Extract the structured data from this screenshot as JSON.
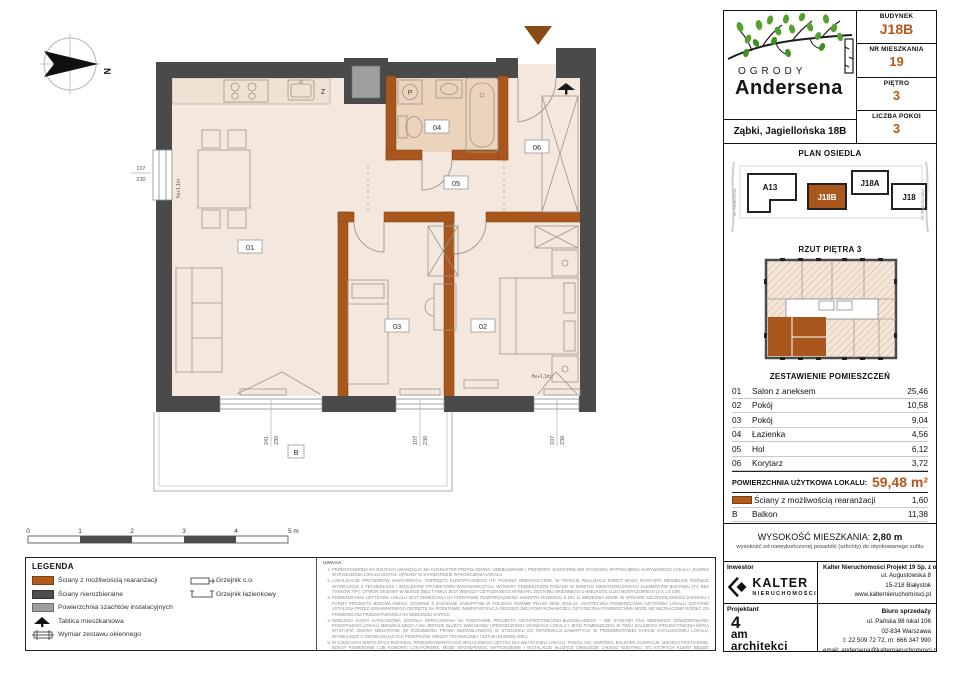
{
  "header": {
    "brand_line1": "OGRODY",
    "brand_line2": "Andersena",
    "address": "Ząbki, Jagiellońska 18B",
    "fields": [
      {
        "label": "BUDYNEK",
        "value": "J18B"
      },
      {
        "label": "NR MIESZKANIA",
        "value": "19"
      },
      {
        "label": "PIĘTRO",
        "value": "3"
      },
      {
        "label": "LICZBA POKOI",
        "value": "3"
      }
    ]
  },
  "site_plan": {
    "title": "PLAN OSIEDLA",
    "buildings": {
      "a13": "A13",
      "j18b": "J18B",
      "j18a": "J18A",
      "j18": "J18"
    },
    "street_left": "ul. Andersena",
    "street_right": "ul. Jagiellońska"
  },
  "floor_overview": {
    "title": "RZUT PIĘTRA 3"
  },
  "rooms_table": {
    "title": "ZESTAWIENIE POMIESZCZEŃ",
    "rows": [
      {
        "no": "01",
        "name": "Salon z aneksem",
        "area": "25,46"
      },
      {
        "no": "02",
        "name": "Pokój",
        "area": "10,58"
      },
      {
        "no": "03",
        "name": "Pokój",
        "area": "9,04"
      },
      {
        "no": "04",
        "name": "Łazienka",
        "area": "4,56"
      },
      {
        "no": "05",
        "name": "Hol",
        "area": "6,12"
      },
      {
        "no": "06",
        "name": "Korytarz",
        "area": "3,72"
      }
    ],
    "total_label": "POWIERZCHNIA UŻYTKOWA LOKALU:",
    "total_value": "59,48 m²",
    "rearr_row": {
      "name": "Ściany z możliwością rearanżacji",
      "area": "1,60"
    },
    "balcony_row": {
      "no": "B",
      "name": "Balkon",
      "area": "11,38"
    }
  },
  "height_info": {
    "label": "WYSOKOŚĆ MIESZKANIA:",
    "value": "2,80 m",
    "note": "wysokość od niewykończonej posadzki (szlichty) do otynkowanego sufitu"
  },
  "footer": {
    "investor_label": "Inwestor",
    "investor_logo_line1": "KALTER",
    "investor_logo_line2": "NIERUCHOMOŚCI",
    "company_name": "Kalter Nieruchomości Projekt 19 Sp. z o.o.",
    "company_lines": [
      "ul. Augustowska 8",
      "15-218 Białystok",
      "www.kalternieruchomosci.pl"
    ],
    "designer_label": "Projektant",
    "designer_line1": "4",
    "designer_line2": "am",
    "designer_line3": "architekci",
    "sales_title": "Biuro sprzedaży",
    "sales_lines": [
      "ul. Pańska 98 lokal 106",
      "02-834 Warszawa",
      "t: 22 509 72 72, m: 666 347 990",
      "email: andersena@kalternieruchomosci.pl"
    ]
  },
  "legend": {
    "title": "LEGENDA",
    "col1": [
      {
        "label": "Ściany z możliwością rearanżacji"
      },
      {
        "label": "Ściany nierozbieralne"
      },
      {
        "label": "Powierzchnia szachtów instalacyjnych"
      },
      {
        "label": "Tablica mieszkaniowa"
      },
      {
        "label": "Wymiar zestawu okiennego"
      }
    ],
    "col2": [
      {
        "label": "Grzejnik c.o."
      },
      {
        "label": "Grzejnik łazienkowy"
      }
    ]
  },
  "notes": {
    "title": "UWAGA:",
    "items": [
      "PRZEDSTAWIONA NA RZUTACH ARANŻACJA MA CHARAKTER PRZYKŁADOWY. UMEBLOWANIE I PRZYBORY SANITARNE NIE STANOWIĄ WYPOSAŻENIA NABYWANEGO LOKALU. ZAKRES WYPOSAŻENIA LOKALU ZOSTAŁ OPISANY W STANDARDZIE WYKOŃCZENIA LOKALU.",
      "LOKALIZACJE PRZYBORÓW SANITARNYCH, OSPRZĘTU ELEKTRYCZNEGO ITP. PODANO ORIENTACYJNIE. W TRAKCIE REALIZACJI ROBÓT MOGĄ WYSTĄPIĆ NIEWIELKIE RÓŻNICE WYNIKAJĄCE Z TECHNOLOGII I WZGLĘDÓW PROJEKTOWO-WYKONAWCZYCH. WYMIARY POMIESZCZEŃ PODANO W ŚWIETLE NIEWYKOŃCZONYCH ELEMENTÓW BUDYNKU (TJ. BEZ TYNKÓW ITP.). OTWÓR OKIENNY W MURZE (BEZ TYNKU) JEST WIĘKSZY OD PODANEGO WYMIARU ZESTAWU OKIENNEGO O WIELKOŚĆ LUZU MONTAŻOWEGO (2 X 1,5 CM).",
      "POWIERZCHNIA UŻYTKOWA LOKALU JEST OKREŚLONA NA PODSTAWIE ROZPORZĄDZENIA MINISTRA ROZWOJU Z DN. 11 WRZEŚNIA 2020R. W SPRAWIE SZCZEGÓŁOWEGO ZAKRESU I FORMY PROJEKTU BUDOWLANEGO, ZGODNIE Z ZASADAMI ZAWARTYMI W POLSKIEJ NORMIE PN-ISO 9836: 2015-12. OSTATECZNA POWIERZCHNIA UŻYTKOWA LOKALU ZOSTANIE USTALONA PRZEZ UPRAWNIONEGO GEODETĘ NA PODSTAWIE INWENTARYZACJI GEODEZYJNEJ POWYKONAWCZEJ. OSTATECZNA POWIERZCHNIA MOŻE SIĘ NIEZNACZNIE RÓŻNIĆ OD POWIERZCHNI PRZEDSTAWIONEJ NA NINIEJSZEJ KARCIE.",
      "NINIEJSZA KARTA KATALOGOWA ZOSTAŁA OPRACOWANA NA PODSTAWIE PROJEKTU ARCHITEKTONICZNO-BUDOWLANEGO – NIE STANOWI ONA WIERNEGO ODWZOROWANIA POWSTAŁEGO LOKALU MIESZKALNEGO A MA JEDYNIE SŁUŻYĆ WSKAZANIU UPROSZCZONEJ ARANŻACJI LOKALU I JEGO POMIESZCZEŃ. W TOKU DALSZEGO PROJEKTOWANIA MOGĄ WYSTĄPIĆ ZMIANY NIEISTOTNE (W ROZUMIENIU PRAWA BUDOWLANEGO) W STOSUNKU DO INFORMACJI ZAWARTYCH W PRZEDMIOTOWEJ KARCIE KATALOGOWEJ LOKALU, WYNIKAJĄCE Z OBOWIĄZUJĄCYCH PRZEPISÓW, WIEDZY TECHNICZNEJ I SZTUKI BUDOWLANEJ.",
      "W CZĘŚCIACH WSPÓLNYCH BUDYNKU, PRZEWIDYWANYCH DO WYŁĄCZNEGO UŻYTKU DLA WŁAŚCICIELI LOKALU, TAKICH JAK: OGRÓDKI, BALKONY, ELEWACJE, MIEJSCA POSTOJOWE, BOKSY ROWEROWE LUB KOMÓRKI LOKATORSKIE, MOŻE WYSTĘPOWAĆ WYPOSAŻENIE I INSTALACJE SŁUŻĄCE OBSŁUDZE CAŁEGO BUDYNKU, DO KTÓRYCH KLIENT BĘDZIE ZOBOWIĄZANY UMOŻLIWIĆ DOSTĘP.",
      "NINIEJSZA KARTA NIE PRZEDSTAWIA KOMPLETNEGO PROJEKTU WIELOBRANŻOWEGO. RYSUNEK NIE JEST PRZEZNACZONY DO CELÓW WYKONAWCZYCH. SZCZEGÓŁOWE INFORMACJE PROJEKTOWE ZNAJDUJĄ SIĘ W DOKUMENTACJI TECHNICZNO-WYKONAWCZEJ DOSTĘPNEJ DO WGLĄDU DLA KLIENTÓW W BIURZE INWESTORA.",
      "PROJEKT CHRONIONY PRAWEM AUTORSKIM."
    ]
  },
  "plan": {
    "compass_label": "N",
    "room_labels": {
      "salon": "01",
      "pokoj_02": "02",
      "pokoj_03": "03",
      "lazienka": "04",
      "hol": "05",
      "korytarz": "06",
      "balkon": "B",
      "kitchen_z": "Z",
      "washer": "P"
    },
    "window_dims": {
      "left": {
        "w": "107",
        "h": "230"
      },
      "salon": {
        "w": "241",
        "h": "230"
      },
      "pokoj_03": {
        "w": "107",
        "h": "230"
      },
      "pokoj_02": {
        "w": "107",
        "h": "230"
      }
    },
    "fix_label_left": "fix+1,1m",
    "fix_label_pokoj_02": "fix+1,1m",
    "scale_ticks": [
      "0",
      "1",
      "2",
      "3",
      "4"
    ],
    "scale_end": "5 m"
  },
  "colors": {
    "accent": "#b4591c",
    "wall_orange": "#a9571c",
    "wall_dark": "#4a4a4a",
    "room_fill": "#f4e8de",
    "bath_fill": "#ebd3bc",
    "shaft_gray": "#9e9e9e"
  }
}
